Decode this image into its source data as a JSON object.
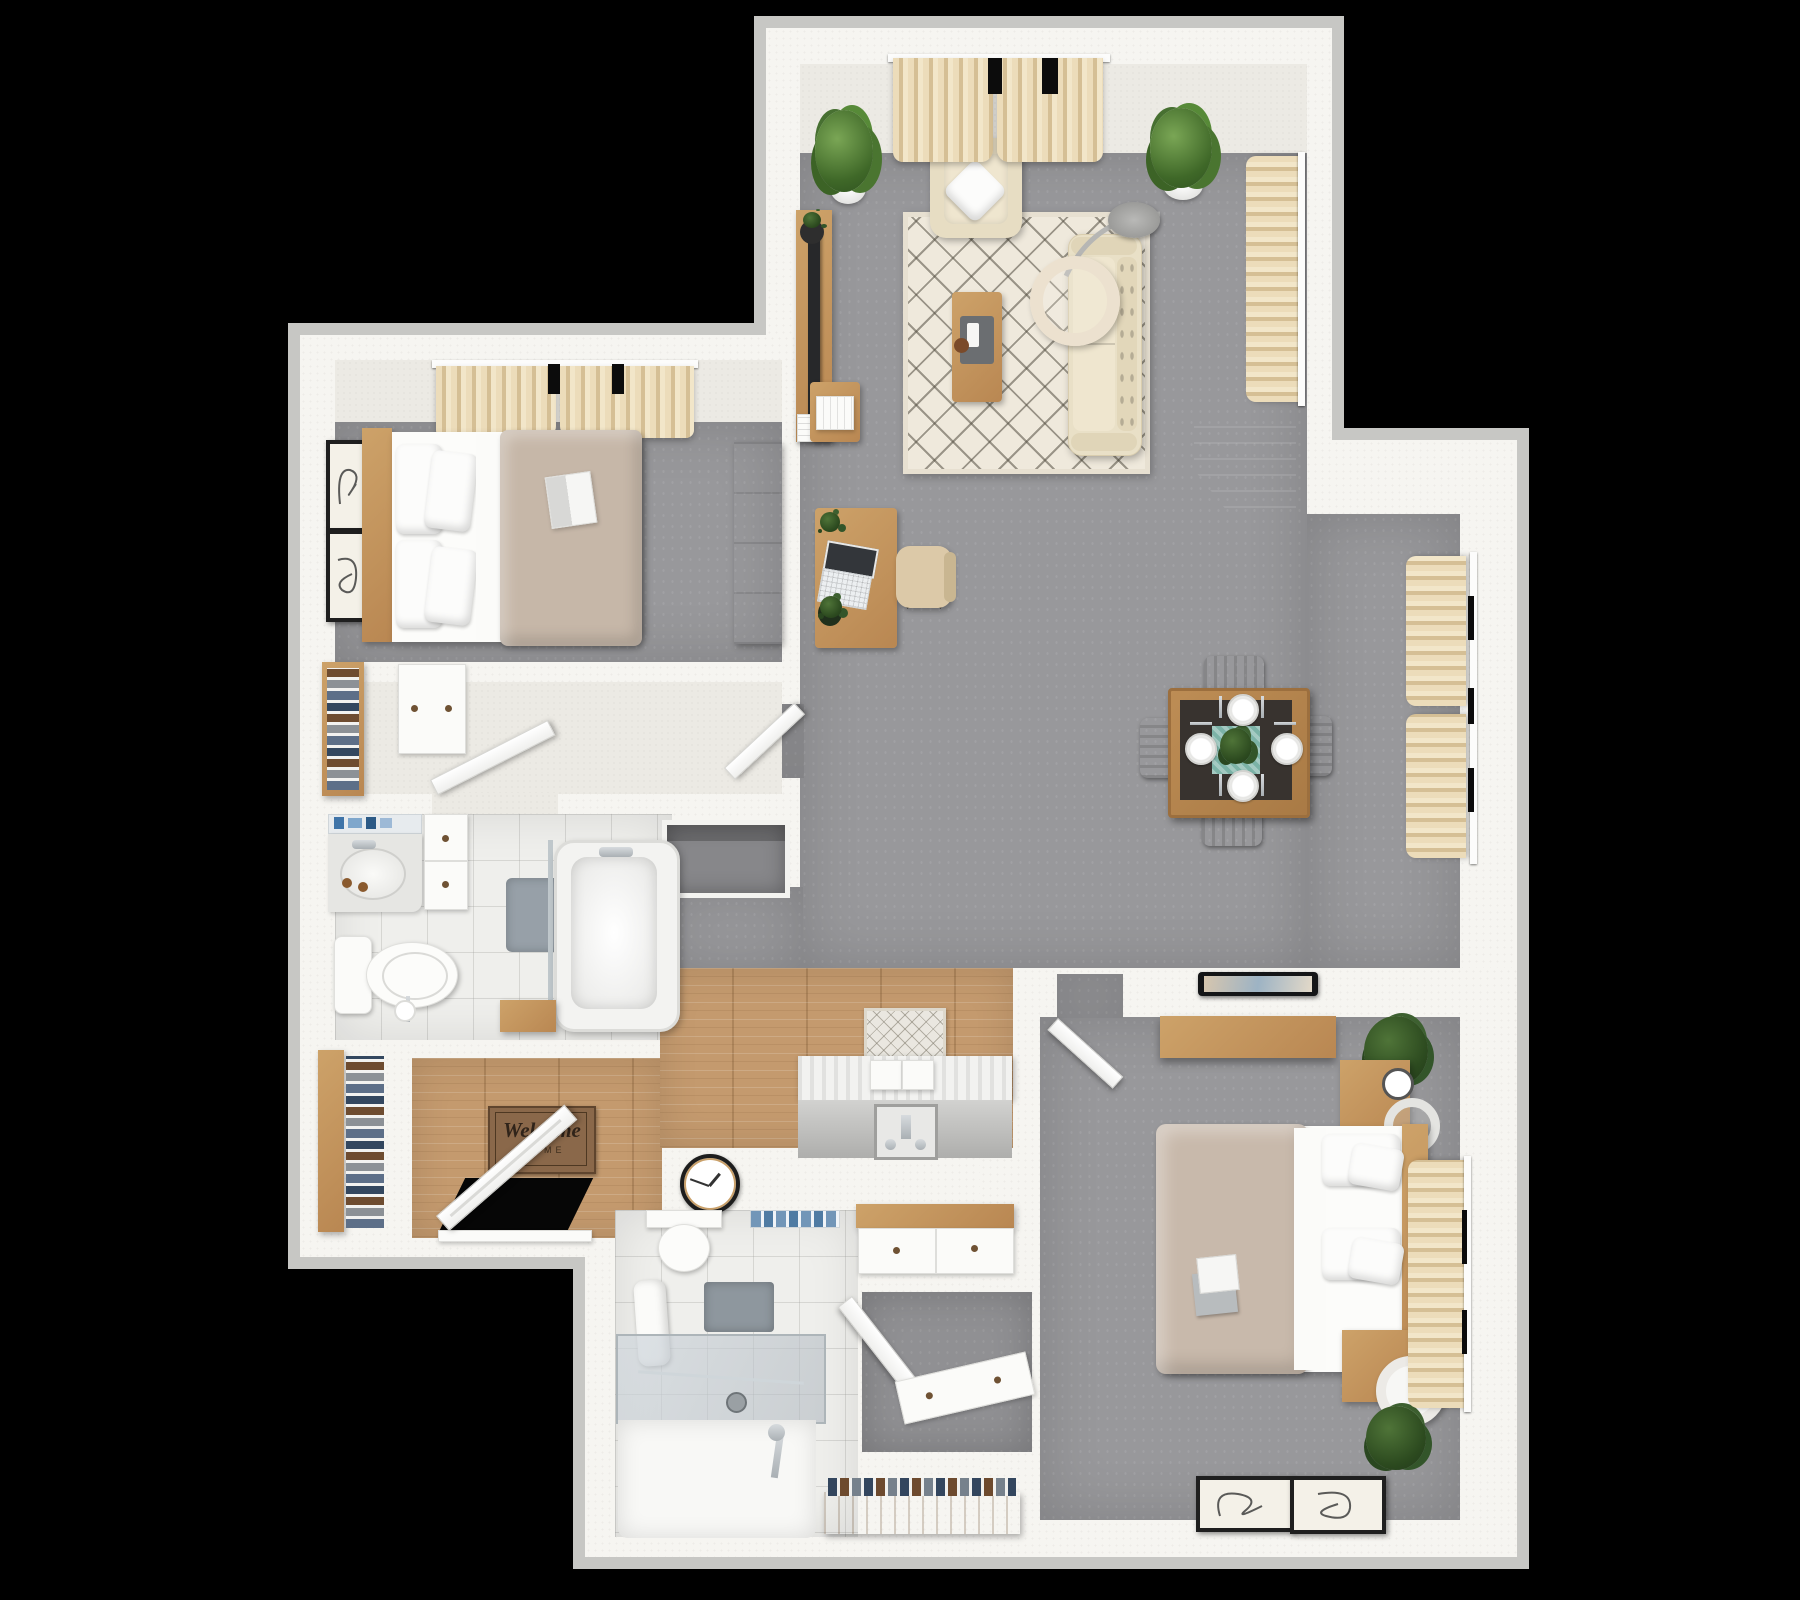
{
  "scene": {
    "kind": "3d-top-down-apartment-floor-plan-render",
    "background_color": "#000000",
    "palette": {
      "wall": "#f6f5f1",
      "wall_edge": "#c7c7c4",
      "carpet": "#98989b",
      "tile": "#efefec",
      "wood_floor": "#c49a6e",
      "oak_furniture": "#c49a63",
      "walnut_furniture": "#8a5c33",
      "beige_upholstery": "#e8dfc6",
      "curtain_beige": "#e3d3ae",
      "duvet_taupe": "#c6b7a8",
      "plant_green": "#3f6828",
      "teal_runner": "#7cb3a7",
      "mat_brown": "#8a684a"
    }
  },
  "entry": {
    "mat": {
      "line1": "Welcome",
      "line2": "HOME"
    },
    "furniture": [
      "coat-closet-shelves",
      "front-door",
      "welcome-mat"
    ]
  },
  "rooms": [
    {
      "name": "living-room",
      "floor": "gray-carpet",
      "furniture": [
        "window-curtains",
        "potted-plant-left",
        "potted-plant-right",
        "armchair",
        "throw-pillow",
        "area-rug",
        "coffee-table",
        "sofa",
        "arc-floor-lamp",
        "tv-console",
        "tv",
        "side-table",
        "desk",
        "laptop",
        "office-chair",
        "patio-curtains",
        "corner-cabinet"
      ]
    },
    {
      "name": "dining-area",
      "floor": "gray-carpet",
      "furniture": [
        "dining-table",
        "dining-chairs-x4",
        "plates-x4",
        "dark-runner",
        "teal-runner",
        "centerpiece-plant",
        "window-curtains"
      ]
    },
    {
      "name": "bedroom-1",
      "floor": "gray-carpet",
      "furniture": [
        "window-curtains",
        "wall-art-x2",
        "bed-headboard",
        "pillows-x4",
        "sheet",
        "taupe-duvet",
        "magazine",
        "dresser"
      ]
    },
    {
      "name": "bedroom-1-hall",
      "floor": "pale-carpet",
      "furniture": [
        "closet-shelves",
        "closet-panel-door",
        "bathroom-door-open",
        "bedroom-door-open"
      ]
    },
    {
      "name": "bathroom-1",
      "floor": "tile",
      "furniture": [
        "mirror-shelf-toiletries",
        "vanity-sink",
        "tall-cabinet",
        "toilet",
        "toilet-paper-stand",
        "bath-mat",
        "bathtub",
        "glass-panel",
        "wood-apron"
      ]
    },
    {
      "name": "hallway",
      "floor": "wood",
      "furniture": [
        "runner-rug",
        "washer-dryer",
        "hookup-box",
        "wall-clock"
      ]
    },
    {
      "name": "bathroom-2",
      "floor": "tile",
      "furniture": [
        "toilet",
        "towel-shelf",
        "hanging-towel",
        "gray-towel",
        "walk-in-shower",
        "shower-glass",
        "shower-wand",
        "drain",
        "vanity-cabinet"
      ]
    },
    {
      "name": "bedroom-2-closet",
      "floor": "gray-carpet",
      "furniture": [
        "sliding-door-panel",
        "closet-door-open",
        "shoe-rack"
      ]
    },
    {
      "name": "bedroom-2",
      "floor": "gray-carpet",
      "furniture": [
        "wall-tablet",
        "floating-shelf",
        "plant-x2",
        "nightstand-x2",
        "alarm-clock",
        "ring-lamp",
        "drum-lamp",
        "bed-headboard",
        "pillows-x4",
        "sheet",
        "taupe-duvet",
        "open-book",
        "wall-art-x2",
        "window-curtains",
        "entry-door-open"
      ]
    }
  ]
}
